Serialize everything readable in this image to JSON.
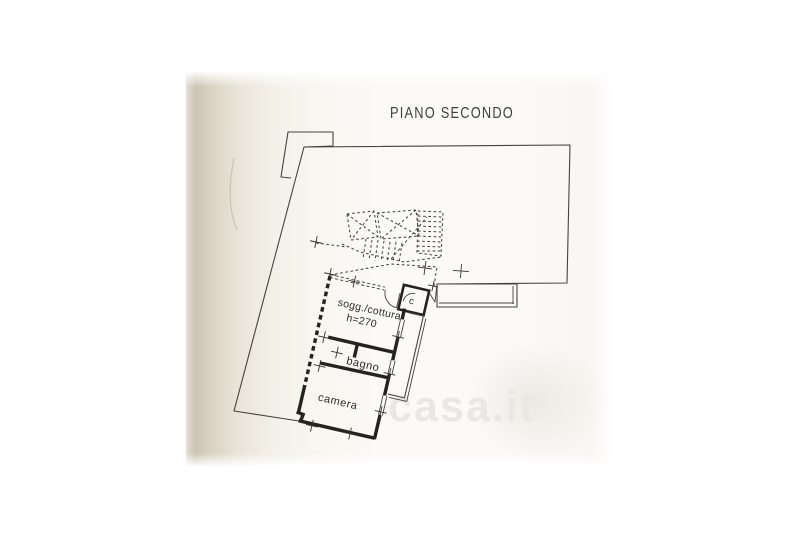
{
  "title": "PIANO SECONDO",
  "watermark": {
    "text": "casa.it"
  },
  "rooms": {
    "living_label": "sogg./cottura",
    "living_height": "h=270",
    "bathroom_label": "bagno",
    "bedroom_label": "camera",
    "closet_label": "c"
  },
  "colors": {
    "ink": "#45443e",
    "wall": "#24231d",
    "paper": "#fbfaf6",
    "paper_edge": "#c2baa9",
    "watermark": "#e9e8e3",
    "background": "#ffffff"
  }
}
